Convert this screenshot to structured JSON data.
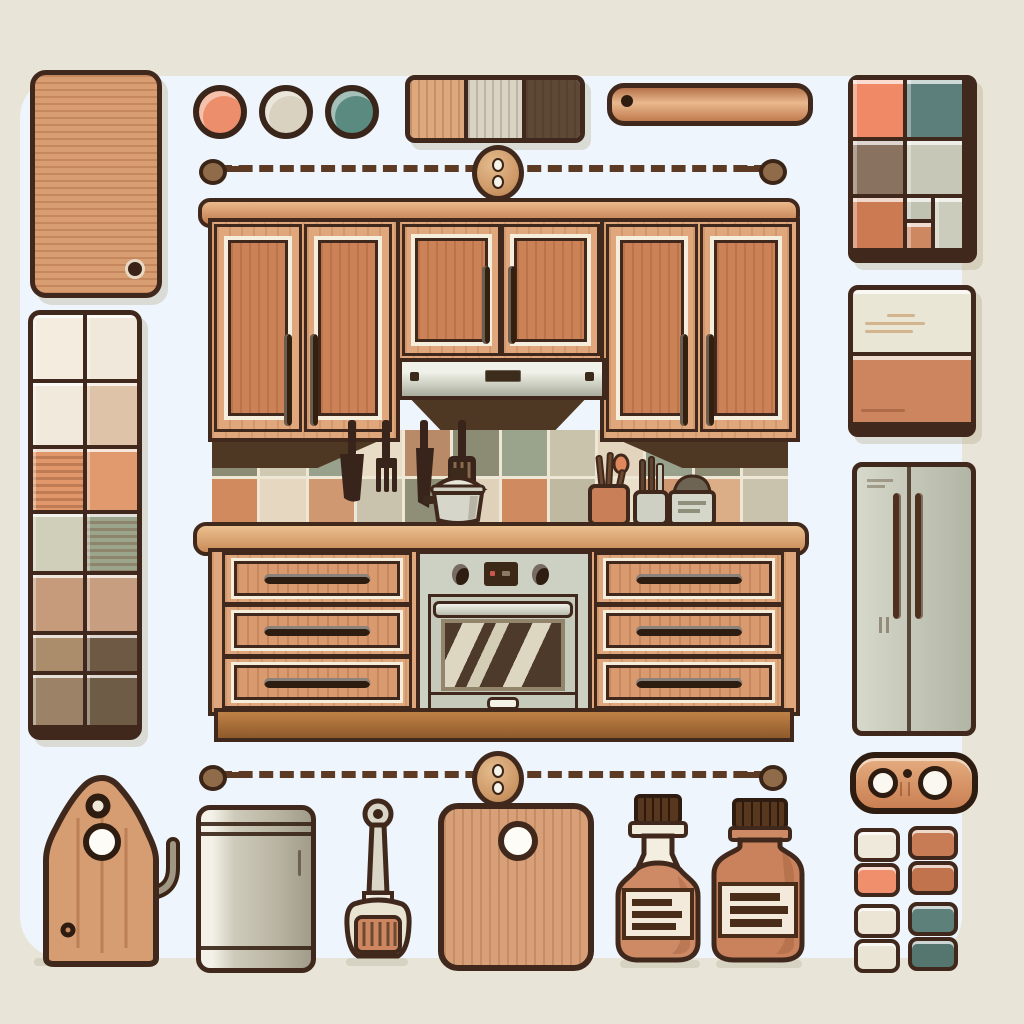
{
  "scene": {
    "background_color": "#e8e5d8",
    "panel_color": "#eef5fc",
    "outline_color": "#40291c"
  },
  "palette_dots": [
    {
      "name": "salmon",
      "color": "#ec8e6b"
    },
    {
      "name": "cream",
      "color": "#d9d2c0"
    },
    {
      "name": "teal",
      "color": "#5b8a80"
    }
  ],
  "wood_strip_swatch": [
    {
      "name": "light-oak",
      "color": "#dfa77c"
    },
    {
      "name": "gray-ash",
      "color": "#d8d3c2"
    },
    {
      "name": "dark-walnut",
      "color": "#5e4936"
    }
  ],
  "top_right_grid": {
    "cells": [
      {
        "name": "salmon",
        "color": "#f08a66"
      },
      {
        "name": "teal",
        "color": "#5d7f7c"
      },
      {
        "name": "taupe",
        "color": "#8a7260"
      },
      {
        "name": "sage-gray",
        "color": "#c6c7b6"
      },
      {
        "name": "terracotta",
        "color": "#cb7a52"
      },
      {
        "name": "gray-small",
        "color": "#c0c2b2"
      },
      {
        "name": "terracotta-small",
        "color": "#cd8862"
      },
      {
        "name": "gray-tall",
        "color": "#ccccbc"
      }
    ]
  },
  "left_tile_swatches": {
    "rows": [
      [
        {
          "c": "#f3ecdf"
        },
        {
          "c": "#f0e9db"
        }
      ],
      [
        {
          "c": "#f1e9dc"
        },
        {
          "c": "#dfc3a8"
        }
      ],
      [
        {
          "c": "#e2976b",
          "striped": true
        },
        {
          "c": "#e09a6e"
        }
      ],
      [
        {
          "c": "#cfcfba"
        },
        {
          "c": "#9aa58c",
          "striped": true
        }
      ],
      [
        {
          "c": "#c59b7b"
        },
        {
          "c": "#c79e80"
        }
      ],
      [
        {
          "c": "#ab8c6b"
        },
        {
          "c": "#6e5a44"
        }
      ],
      [
        {
          "c": "#9c8367"
        },
        {
          "c": "#6f5c46"
        }
      ]
    ]
  },
  "backsplash_tiles": {
    "rows": [
      [
        "#8c8b73",
        "#cfc9b2",
        "#97a18b",
        "#e8dcc6",
        "#b98a68",
        "#8c8b73",
        "#9aa48d",
        "#c9c3ac",
        "#e3d5bd",
        "#97a18b",
        "#8c8b73",
        "#c2bca6"
      ],
      [
        "#d18a5e",
        "#e6d8c0",
        "#cf9871",
        "#c9c3ad",
        "#8f8e76",
        "#e0d2ba",
        "#d08a60",
        "#c0b9a2",
        "#eadfc9",
        "#cf9871",
        "#dcae88",
        "#c9c3ad"
      ]
    ]
  },
  "right_swatch_panel": {
    "cells": [
      {
        "name": "cream",
        "color": "#eae6d6"
      },
      {
        "name": "terracotta",
        "color": "#cd8560"
      }
    ]
  },
  "bottom_right_swatches": {
    "columns": [
      [
        "#efe9dc",
        "#ef8f6c",
        "#ece5d6",
        "#eae4d4"
      ],
      [
        "#c87c55",
        "#c1734e",
        "#5e807b",
        "#55756f"
      ]
    ]
  }
}
